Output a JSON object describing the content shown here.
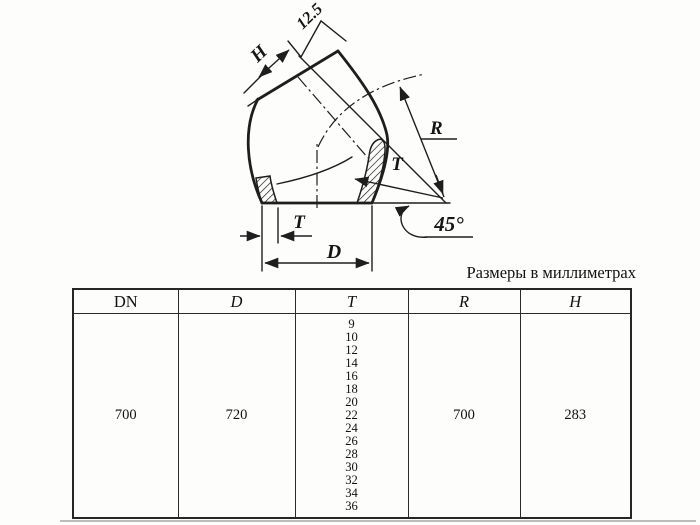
{
  "units_note": "Размеры в миллиметрах",
  "drawing": {
    "labels": {
      "roughness": "12.5",
      "height": "H",
      "radius": "R",
      "wall_upper": "T",
      "wall_lower": "T",
      "diameter": "D",
      "angle": "45°"
    }
  },
  "table": {
    "headers": [
      "DN",
      "D",
      "T",
      "R",
      "H"
    ],
    "row": {
      "dn": "700",
      "d": "720",
      "t_values": [
        "9",
        "10",
        "12",
        "14",
        "16",
        "18",
        "20",
        "22",
        "24",
        "26",
        "28",
        "30",
        "32",
        "34",
        "36"
      ],
      "r": "700",
      "h": "283"
    }
  },
  "colors": {
    "line": "#1e1e1e",
    "faint_rule": "#bdbdbb"
  }
}
